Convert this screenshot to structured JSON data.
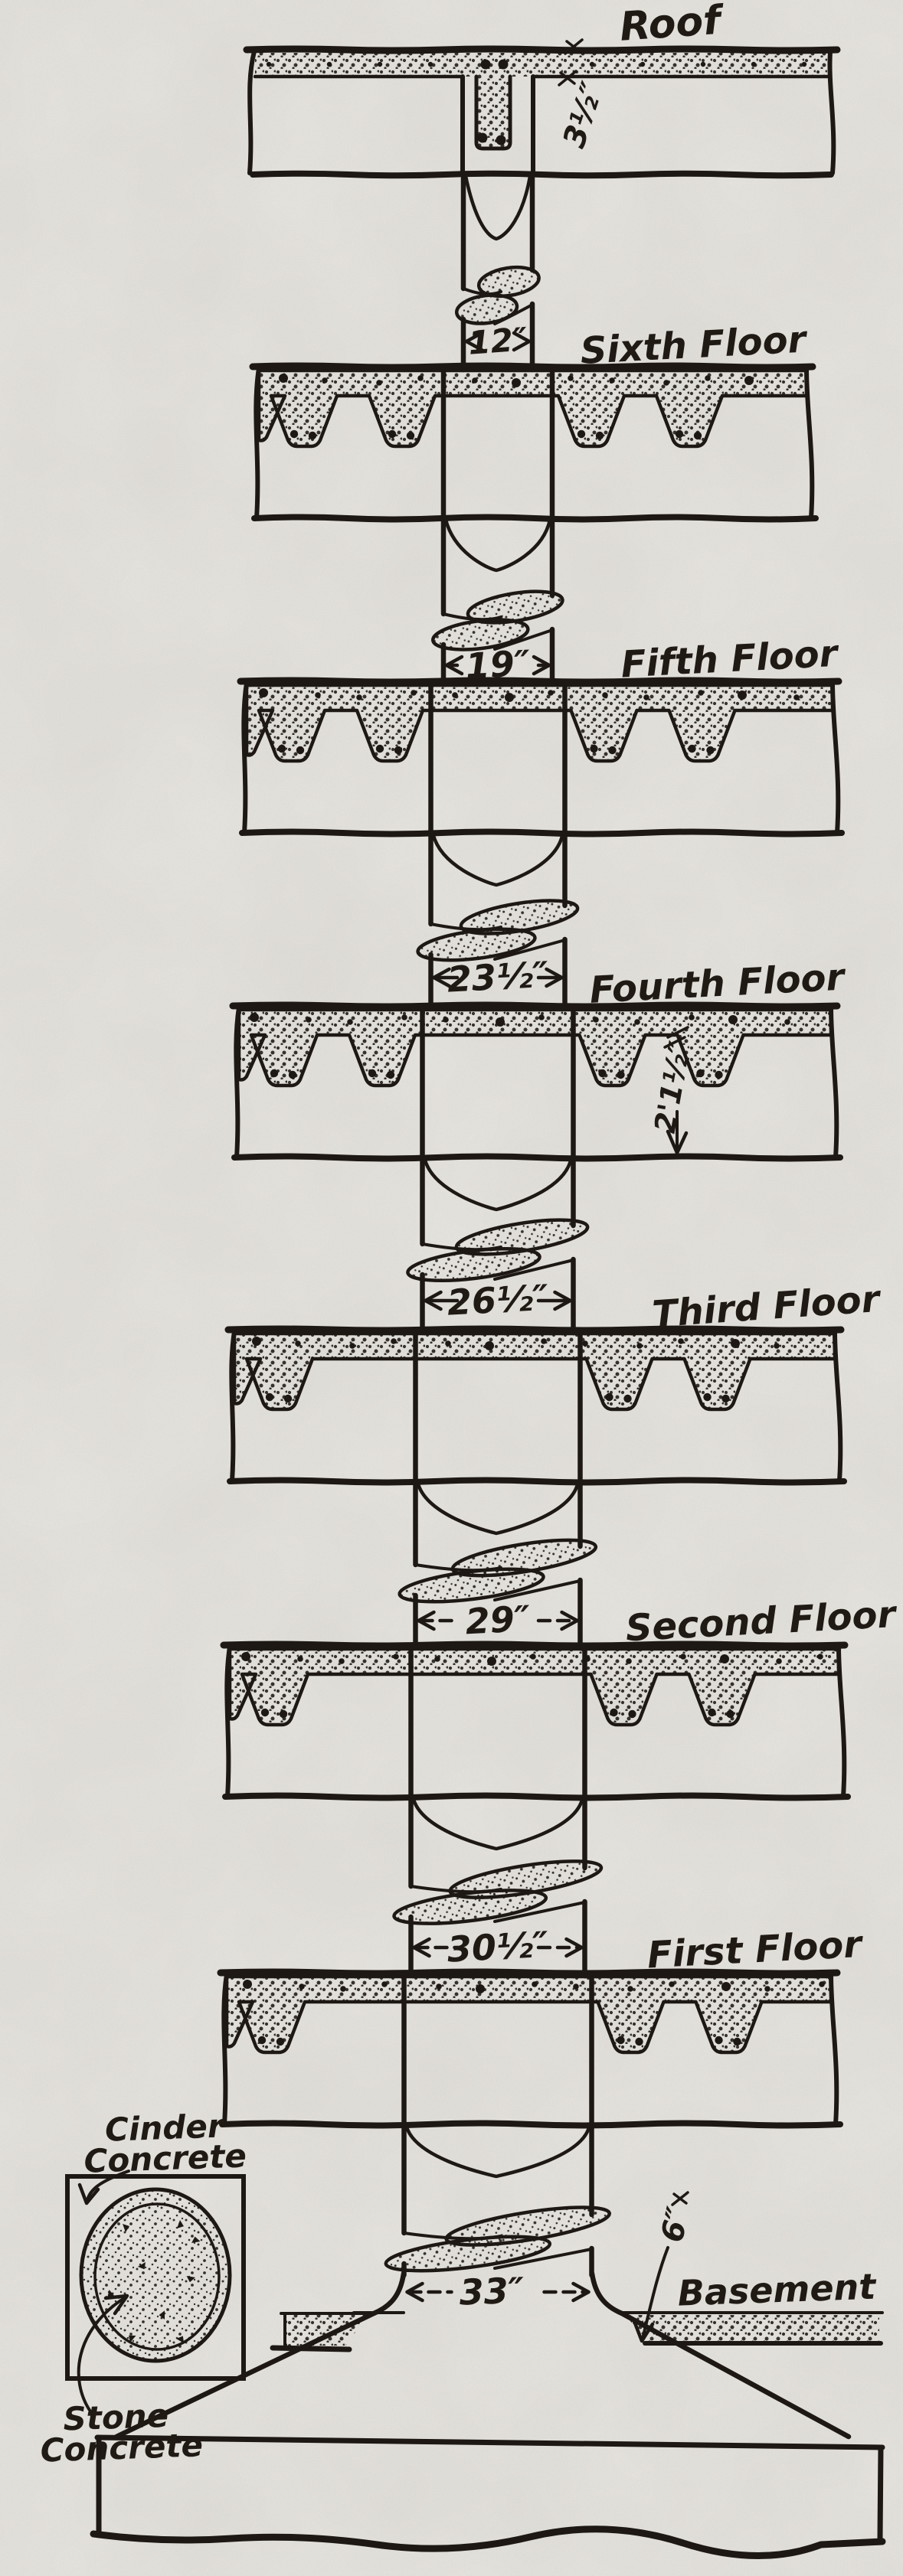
{
  "page": {
    "background": "#e7e5e0",
    "ink": "#1d1813",
    "description": "Sectional elevation of a reinforced concrete building column, roof to footing"
  },
  "roof": {
    "label": "Roof",
    "slab_thickness_dim": "3½″"
  },
  "floors": [
    {
      "label": "Sixth Floor",
      "column_above_dim": "12″"
    },
    {
      "label": "Fifth Floor",
      "column_above_dim": "19″"
    },
    {
      "label": "Fourth Floor",
      "column_above_dim": "23½″",
      "depth_dim": "2'1½″"
    },
    {
      "label": "Third Floor",
      "column_above_dim": "26½″"
    },
    {
      "label": "Second Floor",
      "column_above_dim": "29″"
    },
    {
      "label": "First Floor",
      "column_above_dim": "30½″"
    }
  ],
  "basement": {
    "label": "Basement",
    "column_above_dim": "33″",
    "slab_thickness_dim": "6″"
  },
  "detail": {
    "outer_material": "Cinder Concrete",
    "core_material": "Stone Concrete"
  }
}
